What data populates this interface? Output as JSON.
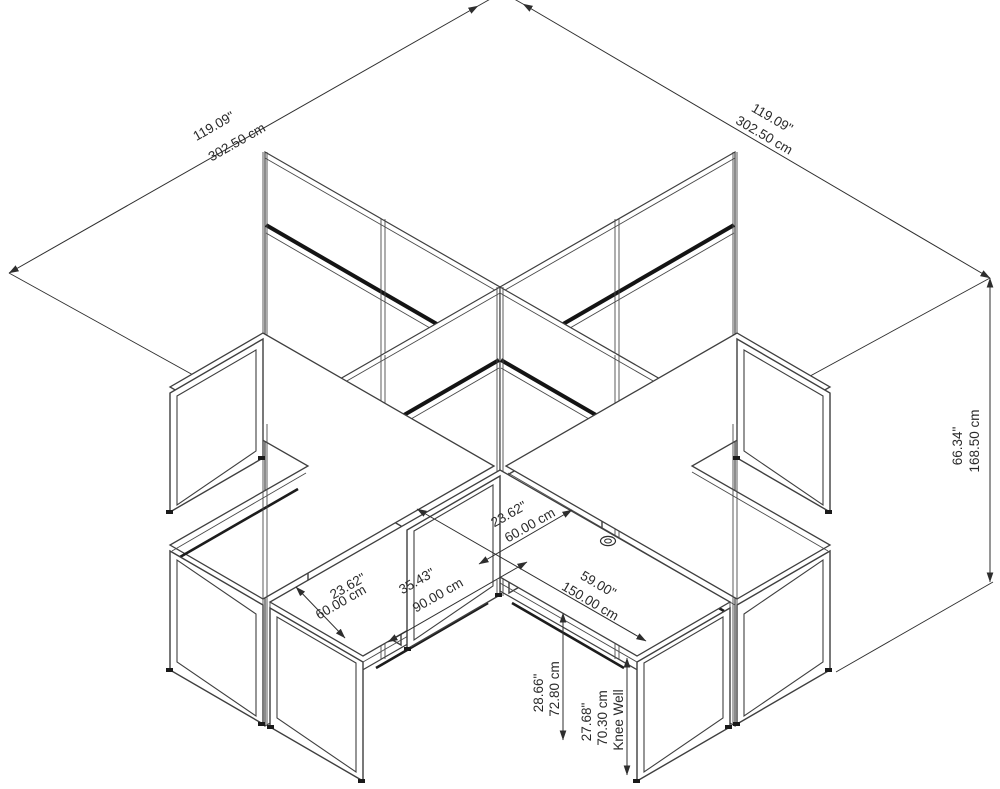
{
  "title": "4 Person X Shaped Cubicle Workstation - Dimensional Drawing",
  "dimensions": {
    "overall_left": {
      "inches": "119.09\"",
      "cm": "302.50 cm"
    },
    "overall_right": {
      "inches": "119.09\"",
      "cm": "302.50 cm"
    },
    "panel_height": {
      "inches": "66.34\"",
      "cm": "168.50 cm"
    },
    "desk_depth": {
      "inches": "23.62\"",
      "cm": "60.00 cm"
    },
    "return_depth": {
      "inches": "23.62\"",
      "cm": "60.00 cm"
    },
    "return_length": {
      "inches": "35.43\"",
      "cm": "90.00 cm"
    },
    "desk_width": {
      "inches": "59.00\"",
      "cm": "150.00 cm"
    },
    "desk_height": {
      "inches": "28.66\"",
      "cm": "72.80 cm"
    },
    "knee_well": {
      "inches": "27.68\"",
      "cm": "70.30 cm",
      "note": "Knee Well"
    }
  },
  "colors": {
    "line": "#3f3f3f",
    "accent_band": "#141414",
    "background": "#ffffff"
  }
}
